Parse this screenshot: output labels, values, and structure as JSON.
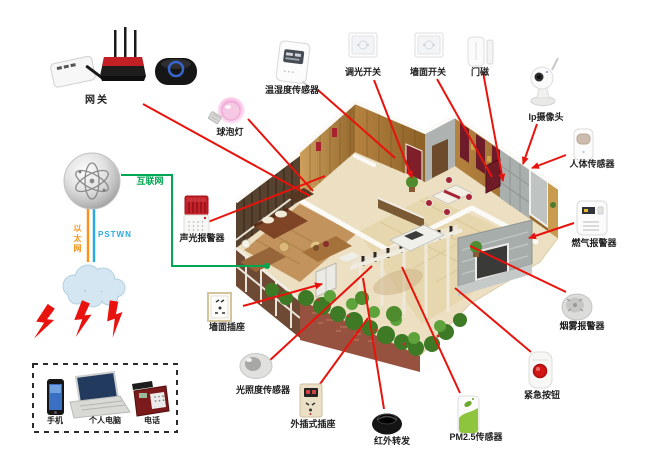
{
  "gateway": {
    "label": "网关"
  },
  "network": {
    "internet": "互联网",
    "ethernet": "以太网",
    "pstn": "PSTWN"
  },
  "terminals": {
    "phone": "手机",
    "pc": "个人电脑",
    "telephone": "电话"
  },
  "devices": {
    "bulb": "球泡灯",
    "temp_humidity": "温湿度传感器",
    "dimmer_switch": "调光开关",
    "wall_switch": "墙面开关",
    "door_magnet": "门磁",
    "ip_camera": "Ip摄像头",
    "human_sensor": "人体传感器",
    "gas_alarm": "燃气报警器",
    "smoke_alarm": "烟雾报警器",
    "emergency_button": "紧急按钮",
    "pm25_sensor": "PM2.5传感器",
    "ir_forwarder": "红外转发",
    "plug_socket": "外插式插座",
    "light_sensor": "光照度传感器",
    "wall_socket": "墙面插座",
    "sound_light_alarm": "声光报警器"
  },
  "colors": {
    "line_red": "#e8130c",
    "line_green": "#00a651",
    "line_orange": "#f7941d",
    "line_blue": "#29abe2"
  }
}
